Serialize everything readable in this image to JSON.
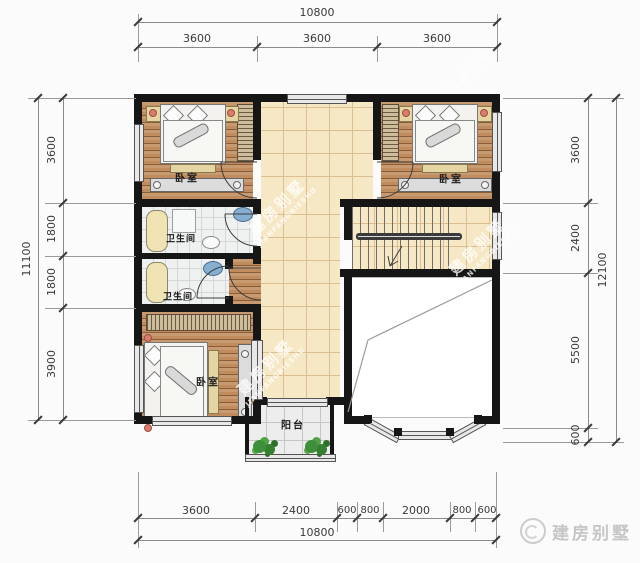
{
  "plan": {
    "type": "residential-floor-plan",
    "rooms": [
      {
        "key": "bedroom-top-left",
        "label": "卧室"
      },
      {
        "key": "bedroom-top-right",
        "label": "卧室"
      },
      {
        "key": "bathroom-upper",
        "label": "卫生间"
      },
      {
        "key": "bathroom-lower",
        "label": "卫生间"
      },
      {
        "key": "bedroom-bottom-left",
        "label": "卧室"
      },
      {
        "key": "balcony",
        "label": "阳台"
      }
    ]
  },
  "dimensions": {
    "top": {
      "total": "10800",
      "segments": [
        "3600",
        "3600",
        "3600"
      ]
    },
    "left": {
      "total": "11100",
      "segments": [
        "3600",
        "1800",
        "1800",
        "3900"
      ]
    },
    "right": {
      "total": "12100",
      "segments": [
        "3600",
        "2400",
        "5500",
        "600"
      ]
    },
    "bottom": {
      "total": "10800",
      "segments": [
        "3600",
        "2400",
        "600",
        "800",
        "2000",
        "800",
        "600"
      ]
    }
  },
  "watermarks": {
    "diagonal_cn": "建房别墅",
    "diagonal_en": "JIANFANGBIESHU"
  },
  "brand": {
    "name": "建房别墅",
    "logo": "house-circle-logo"
  },
  "colors": {
    "wall": "#161616",
    "wood_floor": "#c08c5d",
    "hall_tile": "#f6e7c5",
    "bath_tile": "#eef1f0",
    "plant_green": "#3f8f3a",
    "dimension_text": "#3a3a3a",
    "watermark": "rgba(255,255,255,0.78)",
    "brand_text": "#c6c6c6"
  }
}
